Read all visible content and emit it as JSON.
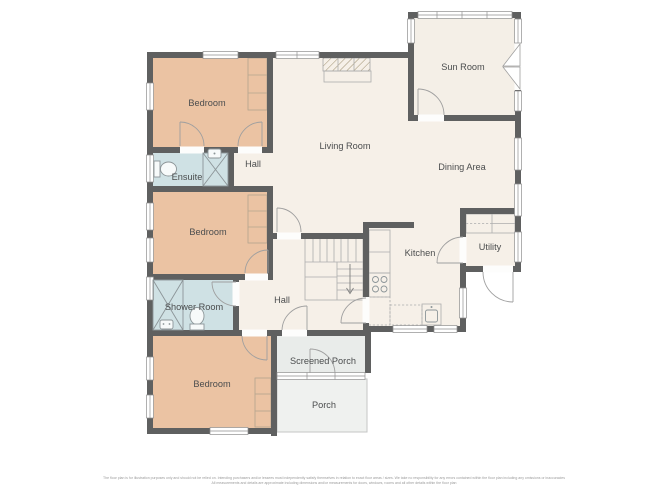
{
  "floor_plan": {
    "rooms": [
      {
        "id": "bedroom-1",
        "label": "Bedroom"
      },
      {
        "id": "ensuite",
        "label": "Ensuite"
      },
      {
        "id": "hall-upper",
        "label": "Hall"
      },
      {
        "id": "living-room",
        "label": "Living Room"
      },
      {
        "id": "sun-room",
        "label": "Sun Room"
      },
      {
        "id": "dining-area",
        "label": "Dining Area"
      },
      {
        "id": "bedroom-2",
        "label": "Bedroom"
      },
      {
        "id": "kitchen",
        "label": "Kitchen"
      },
      {
        "id": "utility",
        "label": "Utility"
      },
      {
        "id": "shower-room",
        "label": "Shower Room"
      },
      {
        "id": "hall-lower",
        "label": "Hall"
      },
      {
        "id": "bedroom-3",
        "label": "Bedroom"
      },
      {
        "id": "screened-porch",
        "label": "Screened Porch"
      },
      {
        "id": "porch",
        "label": "Porch"
      }
    ],
    "disclaimer": {
      "line1": "The floor plan is for illustration purposes only and should not be relied on. Intending purchasers and/or lessees must independently satisfy themselves in relation to exact floor areas / sizes. We take no responsibility for any errors contained within the floor plan including any omissions or inaccuracies",
      "line2": "All measurements and details are approximate including dimensions and/or measurements for doors, windows, rooms and all other details within the floor plan"
    },
    "colors": {
      "wall": "#5f6060",
      "bedroom_fill": "#ebc3a3",
      "bathroom_fill": "#cfe1e4",
      "living_fill": "#f6f0e8",
      "screened_porch_fill": "#e9ecea",
      "porch_fill": "#eff1ef",
      "background": "#ffffff",
      "label_text": "#4b4d4e"
    }
  }
}
